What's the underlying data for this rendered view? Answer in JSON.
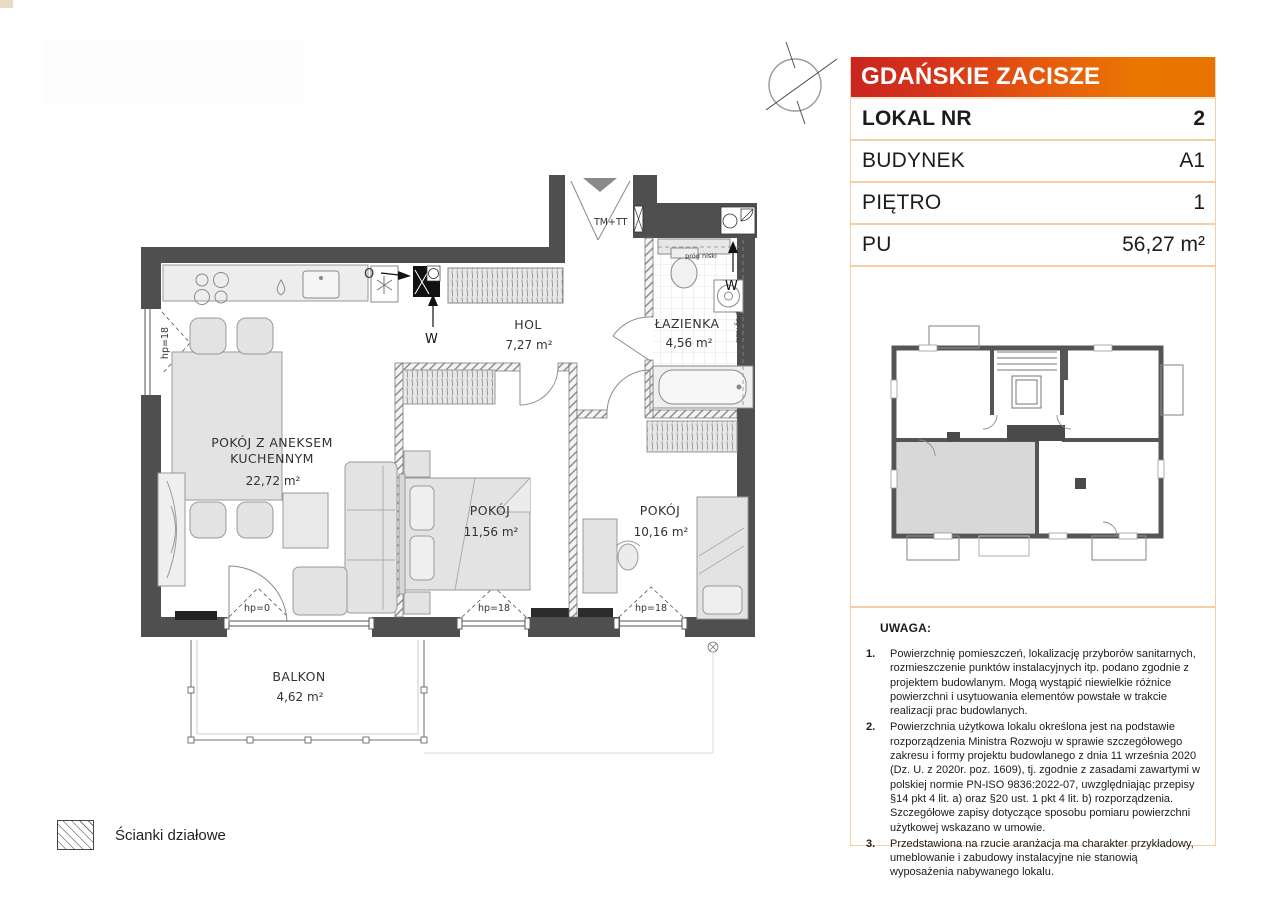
{
  "panel": {
    "project_title": "GDAŃSKIE ZACISZE",
    "rows": [
      {
        "label": "LOKAL NR",
        "value": "2"
      },
      {
        "label": "BUDYNEK",
        "value": "A1"
      },
      {
        "label": "PIĘTRO",
        "value": "1"
      },
      {
        "label": "PU",
        "value": "56,27 m²"
      }
    ]
  },
  "plan": {
    "rooms": {
      "living": {
        "name_line1": "POKÓJ Z ANEKSEM",
        "name_line2": "KUCHENNYM",
        "area": "22,72 m²"
      },
      "hall": {
        "name": "HOL",
        "area": "7,27 m²"
      },
      "bathroom": {
        "name": "ŁAZIENKA",
        "area": "4,56 m²"
      },
      "bedroom1": {
        "name": "POKÓJ",
        "area": "11,56 m²"
      },
      "bedroom2": {
        "name": "POKÓJ",
        "area": "10,16 m²"
      },
      "balcony": {
        "name": "BALKON",
        "area": "4,62 m²"
      }
    },
    "annotations": {
      "entrance": "TM+TT",
      "water": "W",
      "outlet": "O",
      "sill_zero": "hp=0",
      "sill_18": "hp=18",
      "low_threshold": "próg niski"
    }
  },
  "notes": {
    "heading": "UWAGA:",
    "nums": [
      "1.",
      "2.",
      "3."
    ],
    "items": [
      "Powierzchnię pomieszczeń, lokalizację przyborów sanitarnych, rozmieszczenie punktów instalacyjnych itp. podano zgodnie z projektem budowlanym. Mogą wystąpić niewielkie różnice powierzchni i usytuowania elementów powstałe w trakcie realizacji prac budowlanych.",
      "Powierzchnia użytkowa lokalu określona jest na podstawie rozporządzenia Ministra Rozwoju w sprawie szczegółowego zakresu i formy projektu budowlanego z dnia 11 września 2020 (Dz. U. z 2020r. poz. 1609), tj. zgodnie z zasadami zawartymi w polskiej normie PN-ISO 9836:2022-07, uwzględniając przepisy §14 pkt 4 lit. a) oraz §20 ust. 1 pkt 4 lit. b) rozporządzenia. Szczegółowe zapisy dotyczące sposobu pomiaru powierzchni użytkowej wskazano w umowie.",
      "Przedstawiona na rzucie aranżacja ma charakter przykładowy, umeblowanie i zabudowy instalacyjne nie stanowią wyposażenia nabywanego lokalu."
    ]
  },
  "legend": {
    "partition_walls": "Ścianki działowe"
  },
  "colors": {
    "header_gradient_start": "#c9251f",
    "header_gradient_end": "#e87300",
    "panel_border": "#f3cfa7",
    "wall": "#4f4f4f",
    "unit_highlight": "#d8d8d8"
  }
}
